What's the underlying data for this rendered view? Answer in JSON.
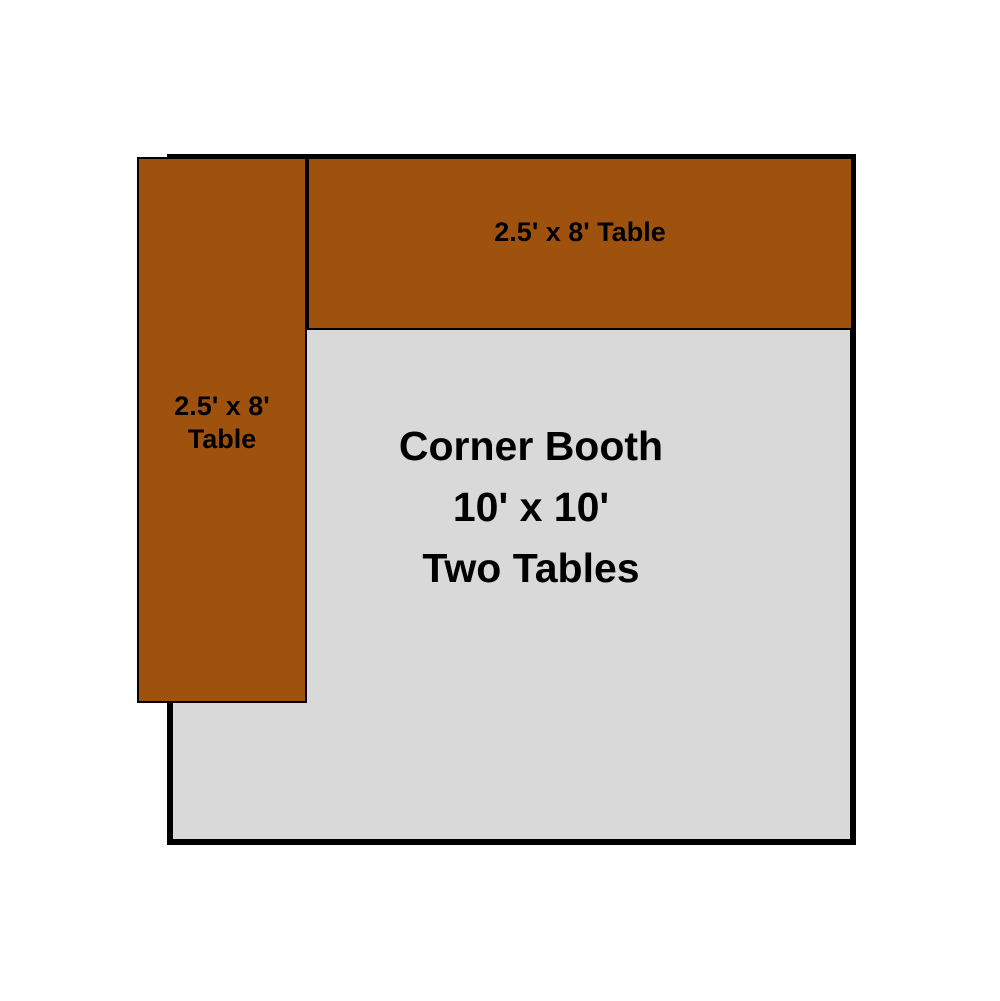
{
  "diagram": {
    "background_color": "#ffffff",
    "text_color": "#000000",
    "booth": {
      "label_lines": [
        "Corner Booth",
        "10' x 10'",
        "Two Tables"
      ],
      "fill_color": "#d9d9d9",
      "border_color": "#000000"
    },
    "top_table": {
      "label": "2.5' x 8' Table",
      "fill_color": "#9e520d",
      "border_color": "#000000"
    },
    "left_table": {
      "label_lines": [
        "2.5' x 8'",
        "Table"
      ],
      "fill_color": "#9e520d",
      "border_color": "#000000"
    }
  }
}
